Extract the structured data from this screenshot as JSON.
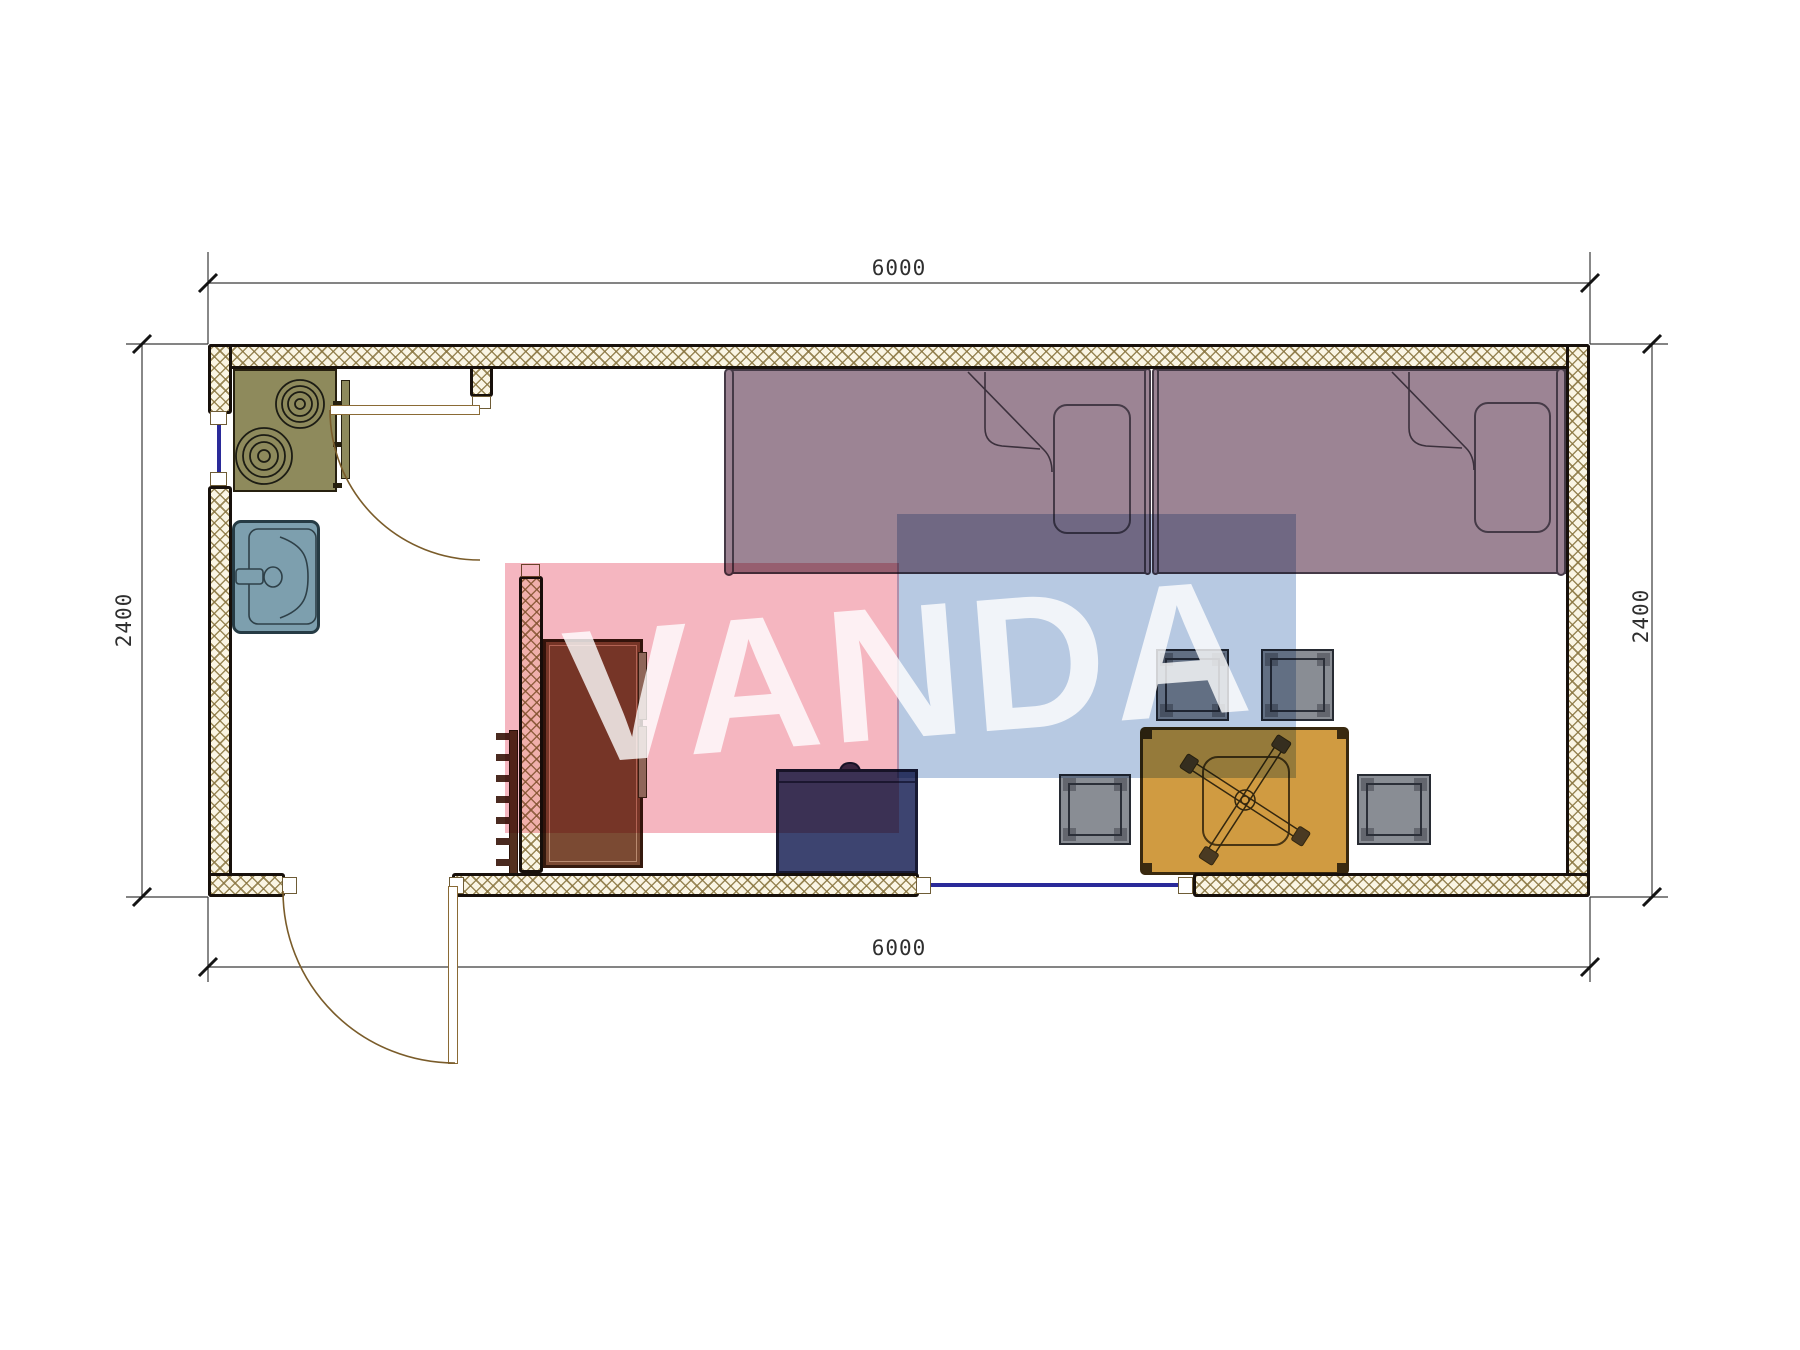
{
  "drawing": {
    "kind": "container-house floor plan",
    "dims": {
      "top": "6000",
      "bottom": "6000",
      "left": "2400",
      "right": "2400"
    },
    "watermark": {
      "text": "VANDA",
      "pink": "#f5b6c0",
      "blue": "#b7c9e2"
    },
    "colors": {
      "wall_hatch": "#8f7c4a",
      "wall_line": "#17100b",
      "bed": "#9c8494",
      "stove": "#8e8a5c",
      "sink": "#7d9fae",
      "wardrobe": "#7b4a33",
      "cabinet": "#3d4470",
      "table": "#d09b41",
      "stool": "#898d94",
      "window_glass": "#2a2a99",
      "door": "#8a6a35"
    },
    "furniture_icons": [
      "stove-icon",
      "sink-icon",
      "single-bed-icon",
      "single-bed-icon",
      "wardrobe-icon",
      "coat-hooks-icon",
      "cabinet-icon",
      "dining-table-icon",
      "stool-icon",
      "stool-icon",
      "stool-icon",
      "stool-icon",
      "door-swing-icon",
      "door-swing-icon",
      "window-icon",
      "window-icon"
    ]
  }
}
